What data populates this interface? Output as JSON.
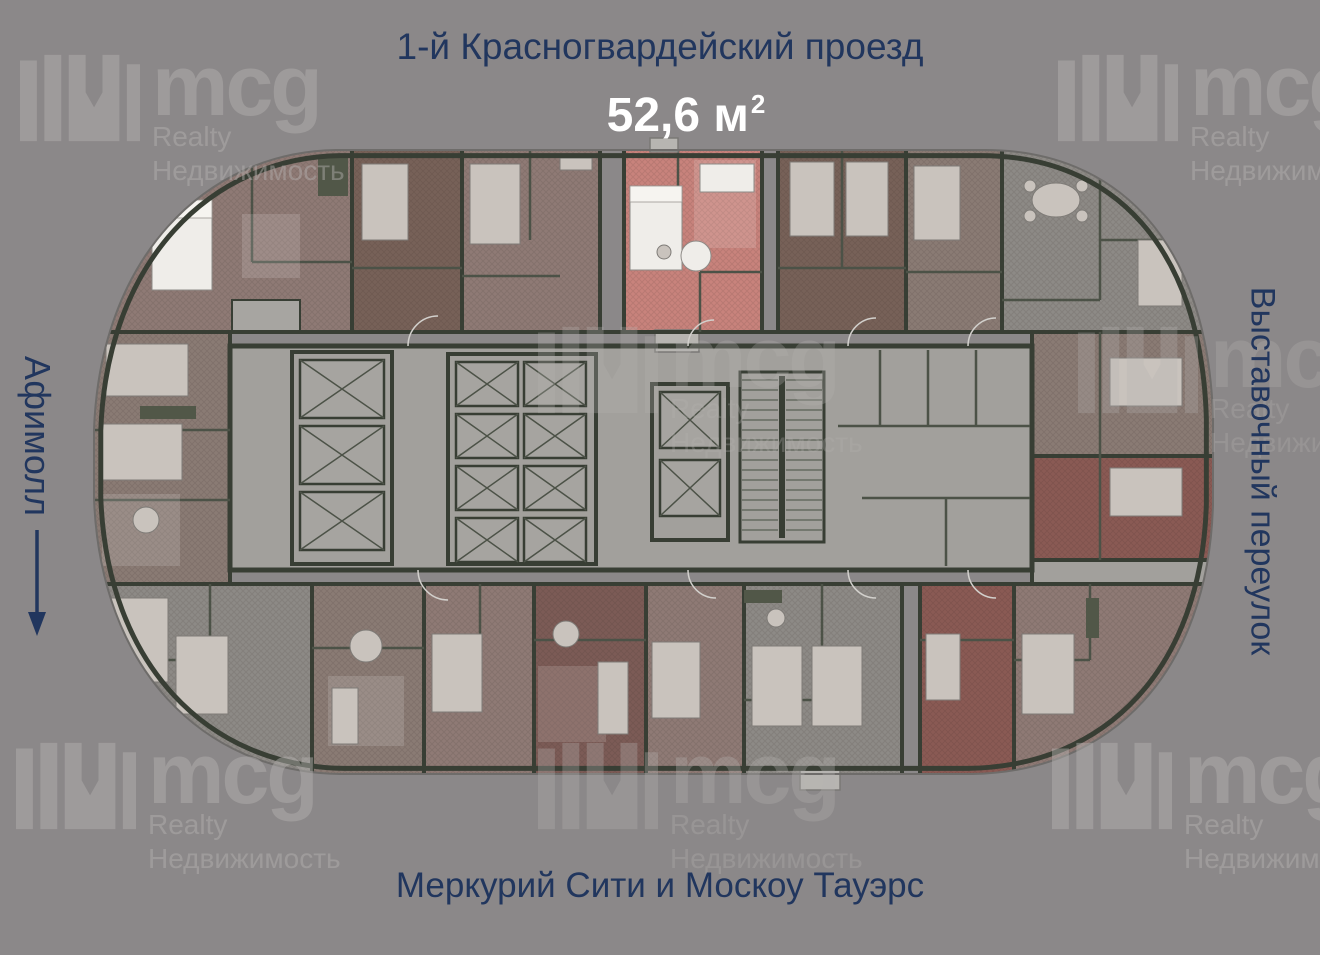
{
  "page": {
    "width": 1320,
    "height": 955
  },
  "labels": {
    "top_street": "1-й Красногвардейский проезд",
    "area_value": "52,6 м",
    "area_sup": "2",
    "left_landmark": "Афимолл",
    "right_street": "Выставочный переулок",
    "bottom_landmark": "Меркурий Сити и Москоу Тауэрс"
  },
  "watermark": {
    "brand": "mcg",
    "line1": "Realty",
    "line2": "Недвижимость"
  },
  "floorplan": {
    "highlighted_unit": {
      "area": "52,6 м²"
    },
    "core": {
      "elevators": 13,
      "staircases": 2
    }
  },
  "icons": {
    "left_arrow": "arrow-down",
    "brand_mark": "mcg-skyline-m"
  },
  "colors": {
    "bg": "#8b8889",
    "navy": "#21365e",
    "white": "#ffffff",
    "wm": "#b6b3b1",
    "wall": "#383e34",
    "walllight": "#4c5247",
    "corridor": "#a2a09c",
    "shaft": "#a6a4a0",
    "mauve": "#8f7a75",
    "maroon": "#776158",
    "darkred": "#7c5b56",
    "red": "#8a5a54",
    "gray": "#8d8a86",
    "graymauve": "#8a7b74",
    "highlight": "#c8837c",
    "furn": "#c9c3bd",
    "furnwhite": "#efede9"
  }
}
